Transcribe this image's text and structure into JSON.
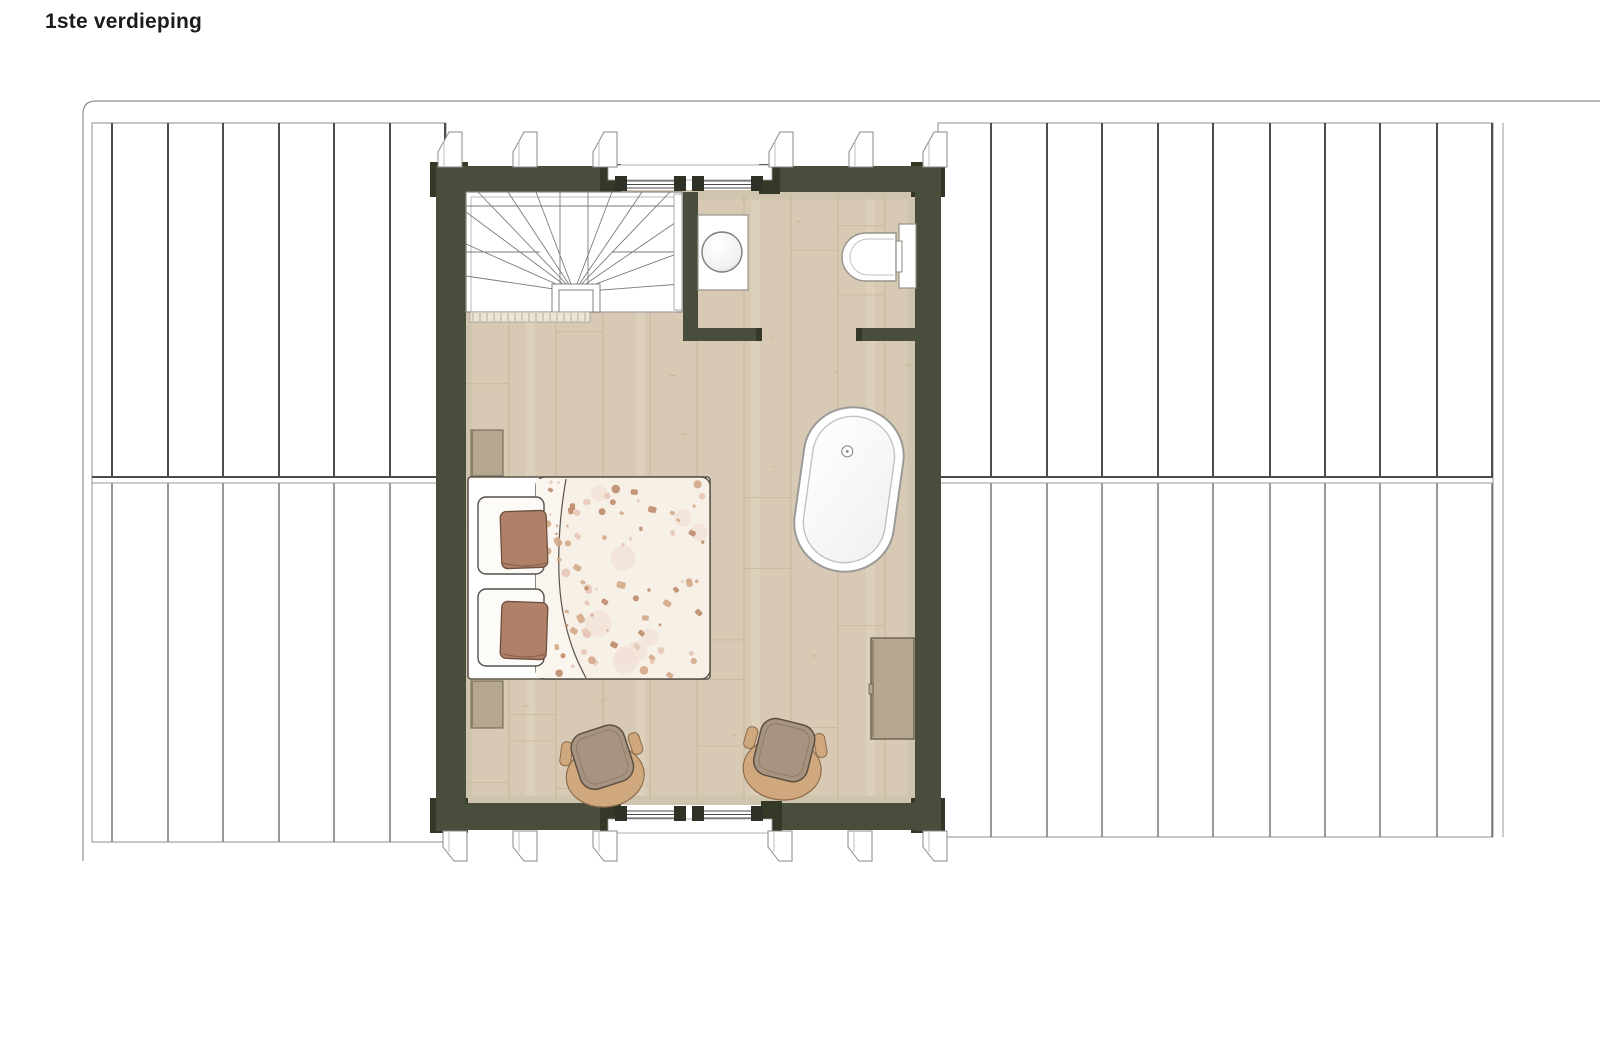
{
  "page": {
    "title": "1ste verdieping"
  },
  "plan": {
    "floor_label": "1ste verdieping",
    "colors": {
      "wall": "#494d3b",
      "wall_dark": "#343827",
      "floor": "#d7c9b3",
      "floor_line": "#c3b49c",
      "trim": "#cfc4ae",
      "roof_dark": "#4c4c4c",
      "roof_light": "#6f6f6f",
      "edge": "#8f8f8f",
      "fixture_outline": "#97938c",
      "duvet": "#f7f0e7",
      "speck_terracotta": "#bf8b6c",
      "speck_pink": "#e6c7b6",
      "speck_tan": "#d3a887",
      "pillow": "#b18068",
      "pillow_outline": "#6e503f",
      "chair_seat": "#a79480",
      "chair_base": "#cfa87e",
      "chair_outline": "#5d4f41",
      "cabinet": "#b4a68f",
      "cabinet_outline": "#6a614f",
      "stair_line": "#7b7b7b",
      "ink": "#1c1c1c"
    },
    "furniture_symbols": [
      "staircase",
      "stair-partition-wall",
      "washbasin",
      "toilet",
      "bathtub",
      "double-bed",
      "pillow",
      "pillow",
      "nightstand",
      "nightstand",
      "armchair",
      "armchair",
      "dresser"
    ],
    "windows": {
      "count": 2
    },
    "roof_panels": {
      "left_count": 7,
      "right_count": 10
    }
  }
}
